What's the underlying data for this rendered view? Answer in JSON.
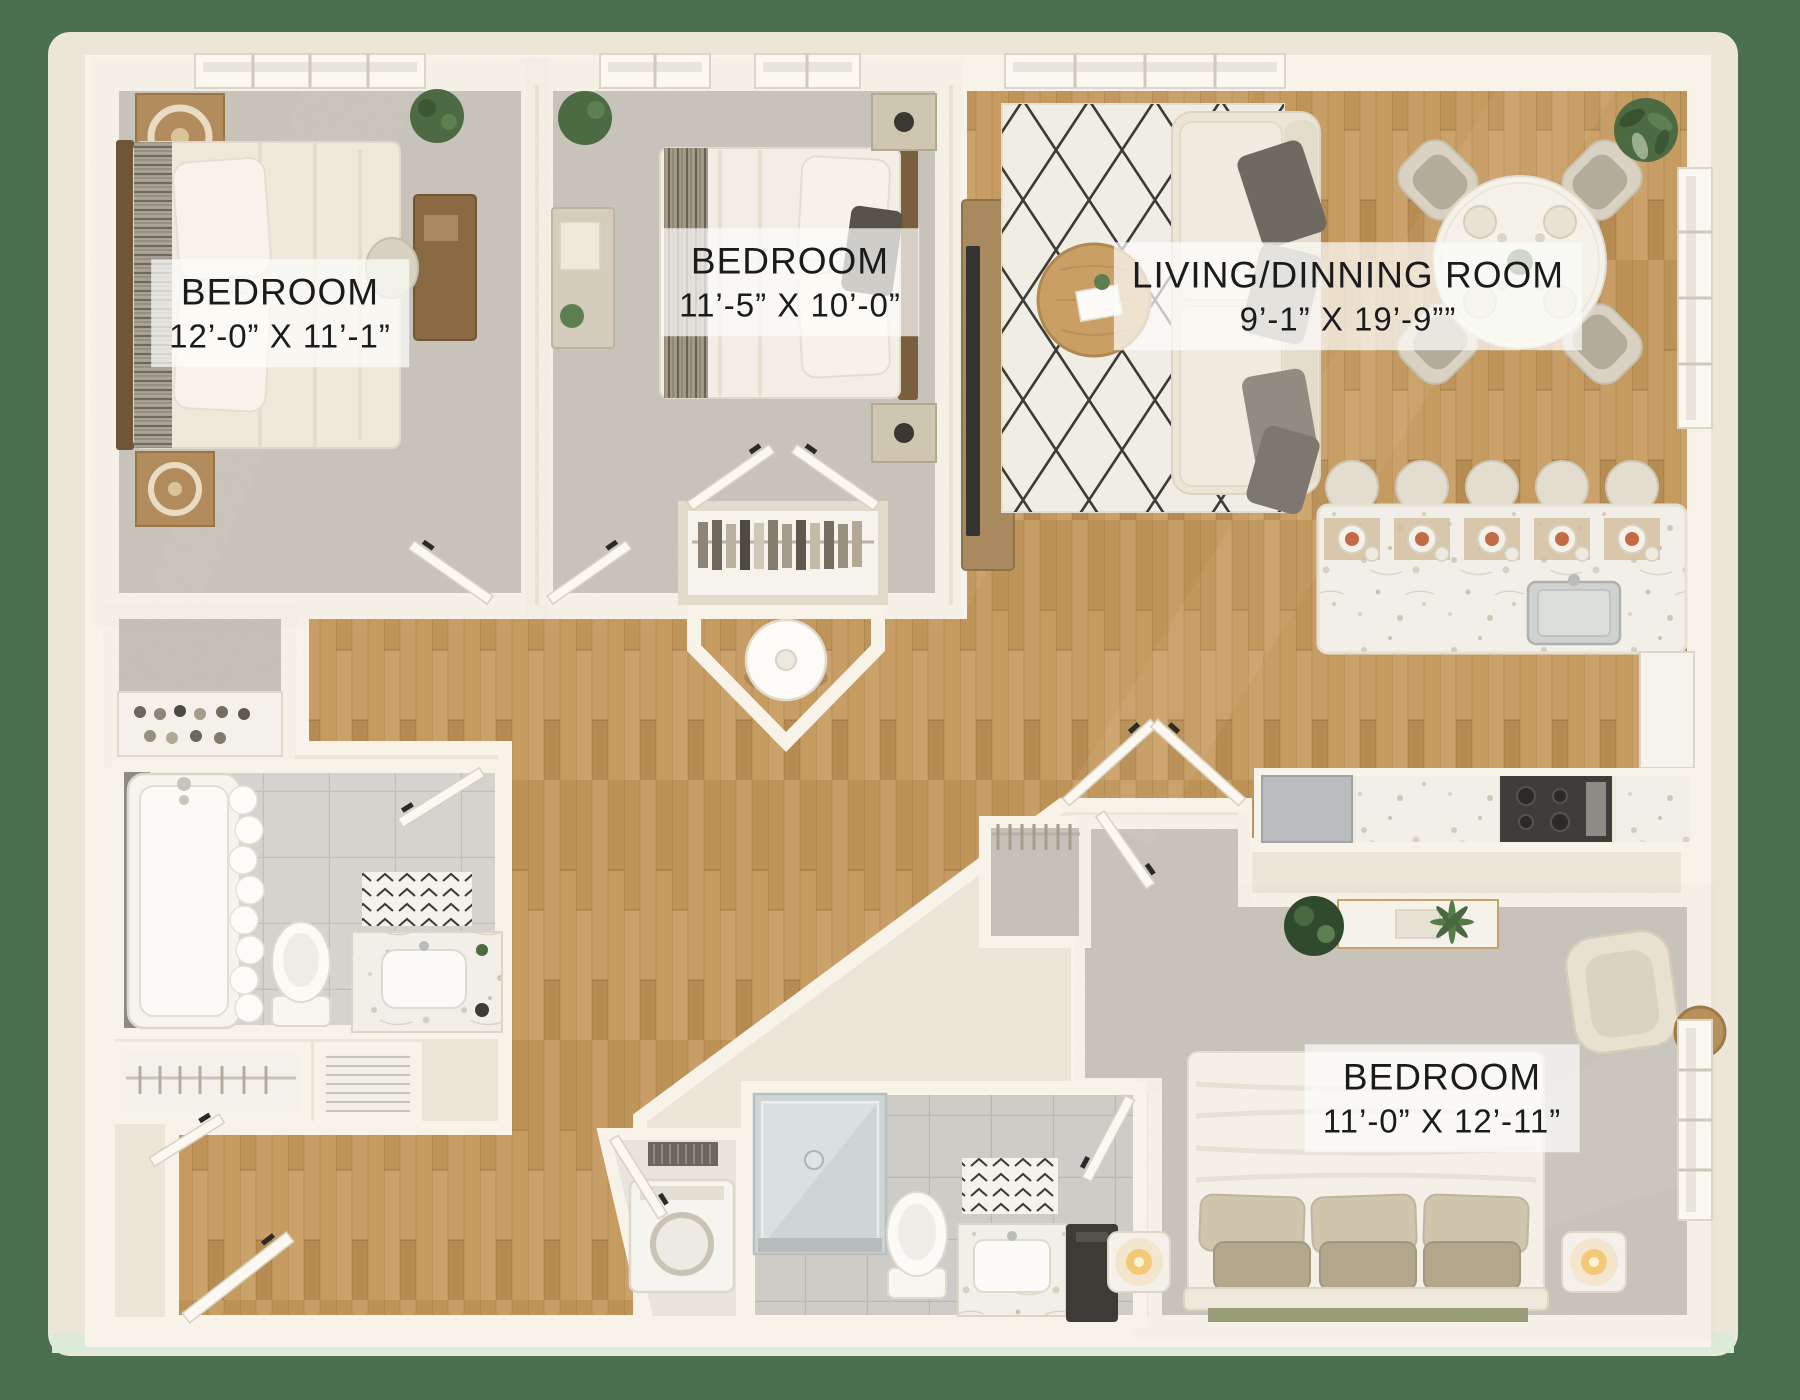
{
  "floor_plan": {
    "rooms": [
      {
        "id": "bedroom-1",
        "label": "BEDROOM",
        "dimensions": "12’-0” X 11’-1”"
      },
      {
        "id": "bedroom-2",
        "label": "BEDROOM",
        "dimensions": "11’-5” X 10’-0”"
      },
      {
        "id": "living-dining-room",
        "label": "LIVING/DINNING ROOM",
        "dimensions": "9’-1” X 19’-9””"
      },
      {
        "id": "bedroom-3",
        "label": "BEDROOM",
        "dimensions": "11’-0” X 12’-11”"
      }
    ],
    "colors": {
      "background_green": "#4a7050",
      "plan_cream": "#ece6d8",
      "wall_white": "#f8f3e9",
      "carpet_gray": "#c9c4bb",
      "wood_floor": "#c49a63",
      "tile_gray": "#d6d3cf",
      "rug_lattice": "#2e2c28",
      "label_text": "#1b1b1b",
      "label_background": "rgba(252,252,250,0.72)"
    }
  }
}
